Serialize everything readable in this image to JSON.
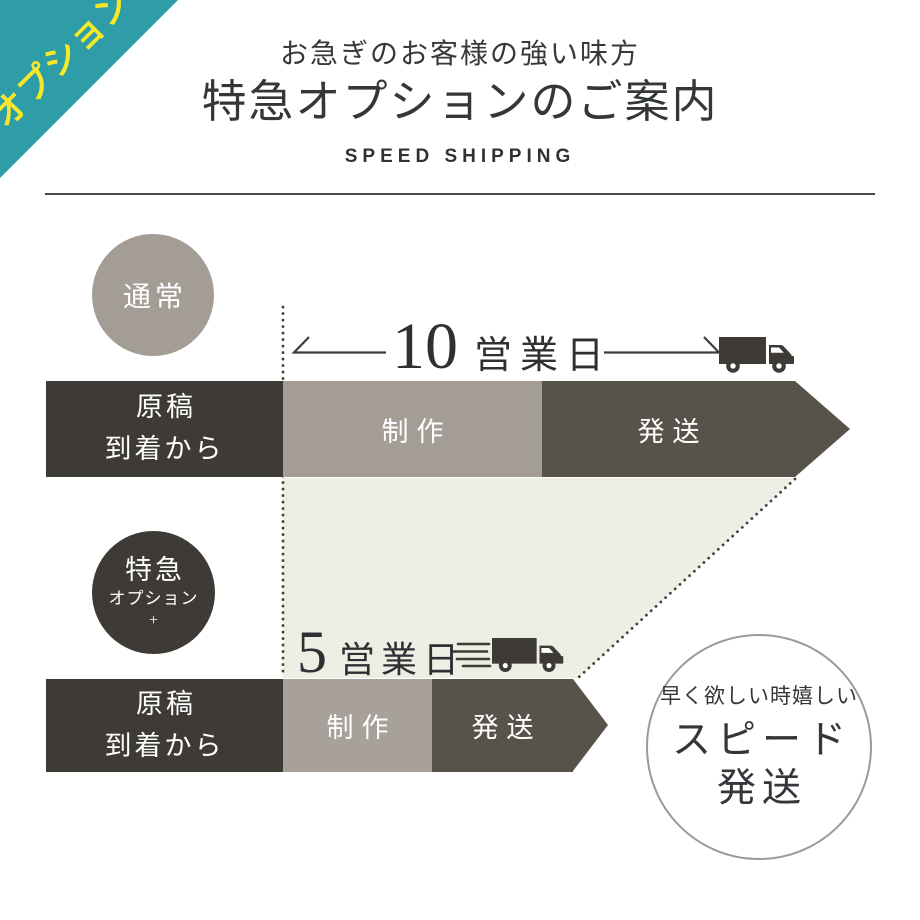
{
  "ribbon": {
    "label": "オプション"
  },
  "header": {
    "tagline": "お急ぎのお客様の強い味方",
    "title": "特急オプションのご案内",
    "subtitle_en": "SPEED SHIPPING"
  },
  "normal": {
    "badge": "通常",
    "duration_number": "10",
    "duration_unit": "営業日",
    "start_label": "原稿\n到着から",
    "production_label": "制作",
    "shipping_label": "発送"
  },
  "express": {
    "badge_title": "特急",
    "badge_subtitle": "オプション",
    "badge_plus": "+",
    "duration_number": "5",
    "duration_unit": "営業日",
    "start_label": "原稿\n到着から",
    "production_label": "制作",
    "shipping_label": "発送"
  },
  "speed_circle": {
    "caption": "早く欲しい時嬉しい",
    "title_line1": "スピード",
    "title_line2": "発送"
  },
  "colors": {
    "ribbon_teal": "#2E9DA7",
    "ribbon_yellow": "#F5E829",
    "dark_charcoal": "#3E3B37",
    "taupe": "#A49D95",
    "olive_gray": "#57534A",
    "saving_zone": "#EDEEE4",
    "heading_text": "#33373A"
  }
}
